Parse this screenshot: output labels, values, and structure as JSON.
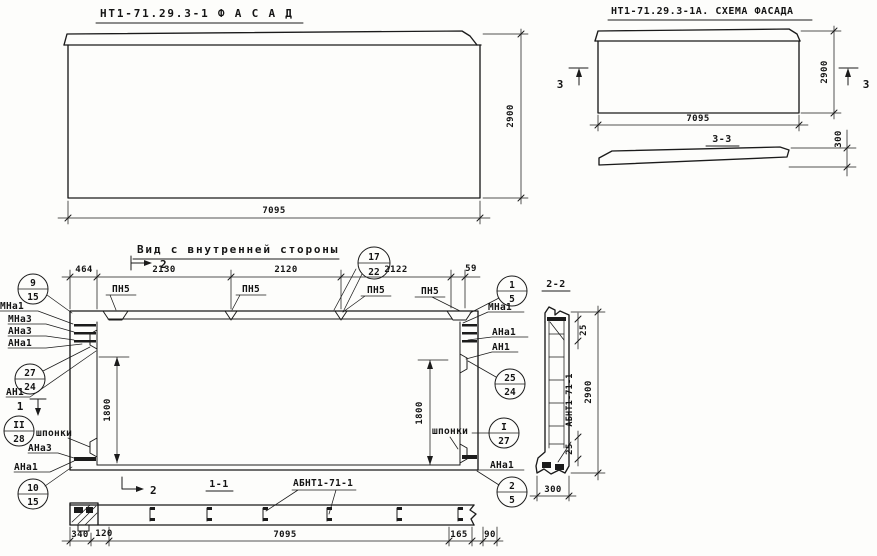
{
  "facade": {
    "title": "НТ1-71.29.3-1   Ф А С А Д",
    "dim_width": "7095",
    "dim_height": "2900"
  },
  "scheme": {
    "title": "НТ1-71.29.3-1А. СХЕМА ФАСАДА",
    "cut_label": "3",
    "dim_width": "7095",
    "dim_height": "2900",
    "section_title": "3-3",
    "dim_thickness": "300"
  },
  "inner": {
    "title": "Вид с внутренней стороны",
    "dims_top": [
      "464",
      "2130",
      "2120",
      "2122",
      "59"
    ],
    "loop_labels": [
      "ПН5",
      "ПН5",
      "ПН5",
      "ПН5"
    ],
    "dim_left_height": "1800",
    "dim_right_height": "1800",
    "cut_top": "2",
    "cut_left": "1",
    "cut_bottom": "2",
    "balloon_top": {
      "top": "17",
      "bottom": "22"
    },
    "balloons_left": [
      {
        "top": "9",
        "bottom": "15"
      },
      {
        "top": "27",
        "bottom": "24"
      },
      {
        "top": "II",
        "bottom": "28"
      },
      {
        "top": "10",
        "bottom": "15"
      }
    ],
    "balloons_right": [
      {
        "top": "1",
        "bottom": "5"
      },
      {
        "top": "25",
        "bottom": "24"
      },
      {
        "top": "I",
        "bottom": "27"
      },
      {
        "top": "2",
        "bottom": "5"
      }
    ],
    "labels_left": [
      "МНа1",
      "МНа3",
      "АНа3",
      "АНа1",
      "АН1",
      "шпонки",
      "АНа3",
      "АНа1"
    ],
    "labels_right": [
      "МНа1",
      "АНа1",
      "АН1",
      "шпонки",
      "АНа1"
    ]
  },
  "section11": {
    "title": "1-1",
    "label": "АБНТ1-71-1",
    "dims": [
      "340",
      "120",
      "7095",
      "165",
      "90"
    ]
  },
  "section22": {
    "title": "2-2",
    "label": "АБНТ1-71-1",
    "dim_top": "25",
    "dim_bottom": "25",
    "dim_height": "2900",
    "dim_width": "300"
  }
}
